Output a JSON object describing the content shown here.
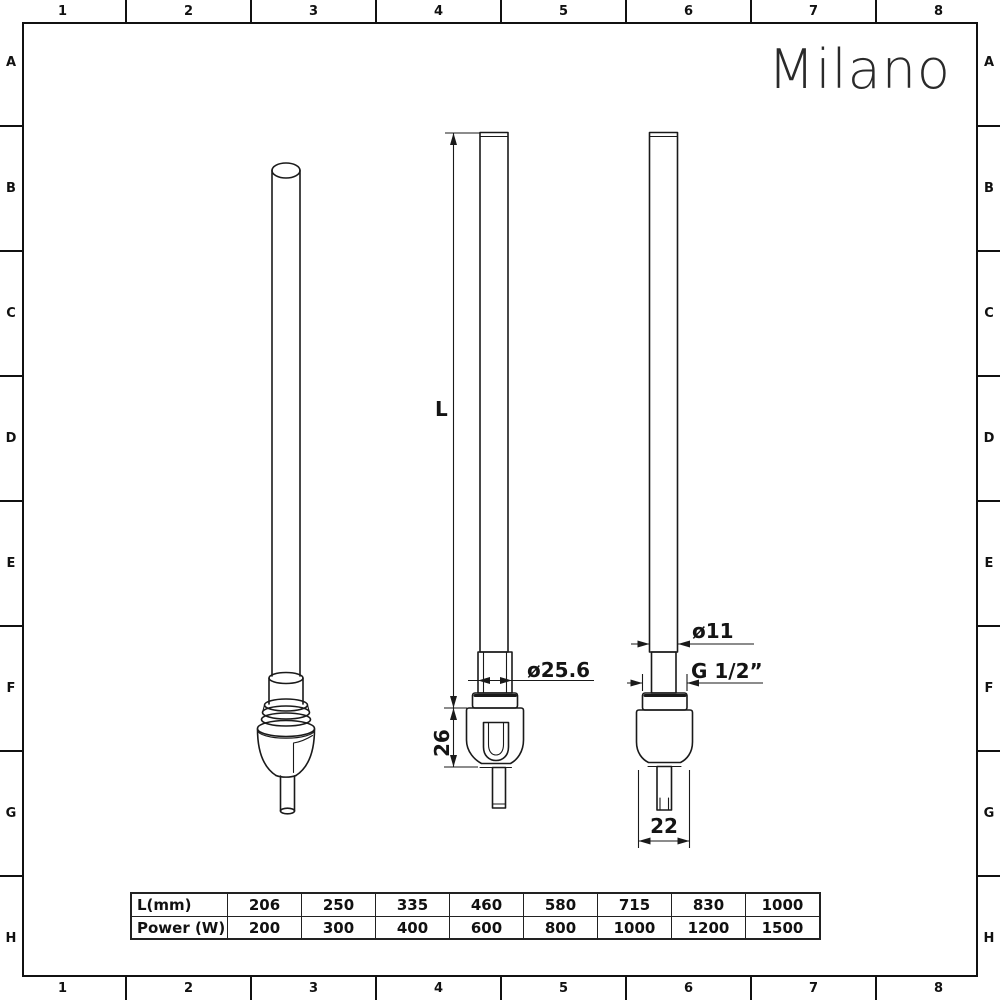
{
  "brand": {
    "logo": "Milano"
  },
  "grid_ref": {
    "columns": [
      "1",
      "2",
      "3",
      "4",
      "5",
      "6",
      "7",
      "8"
    ],
    "rows": [
      "A",
      "B",
      "C",
      "D",
      "E",
      "F",
      "G",
      "H"
    ]
  },
  "drawing": {
    "description": "Three orthographic/isometric views of an electric heating element",
    "dimensions": {
      "length_label": "L",
      "nut_diameter": "ø25.6",
      "body_height": "26",
      "tube_diameter": "ø11",
      "thread": "G 1/2”",
      "probe_width": "22"
    }
  },
  "table": {
    "rows": [
      {
        "label": "L(mm)",
        "values": [
          "206",
          "250",
          "335",
          "460",
          "580",
          "715",
          "830",
          "1000"
        ]
      },
      {
        "label": "Power (W)",
        "values": [
          "200",
          "300",
          "400",
          "600",
          "800",
          "1000",
          "1200",
          "1500"
        ]
      }
    ]
  }
}
